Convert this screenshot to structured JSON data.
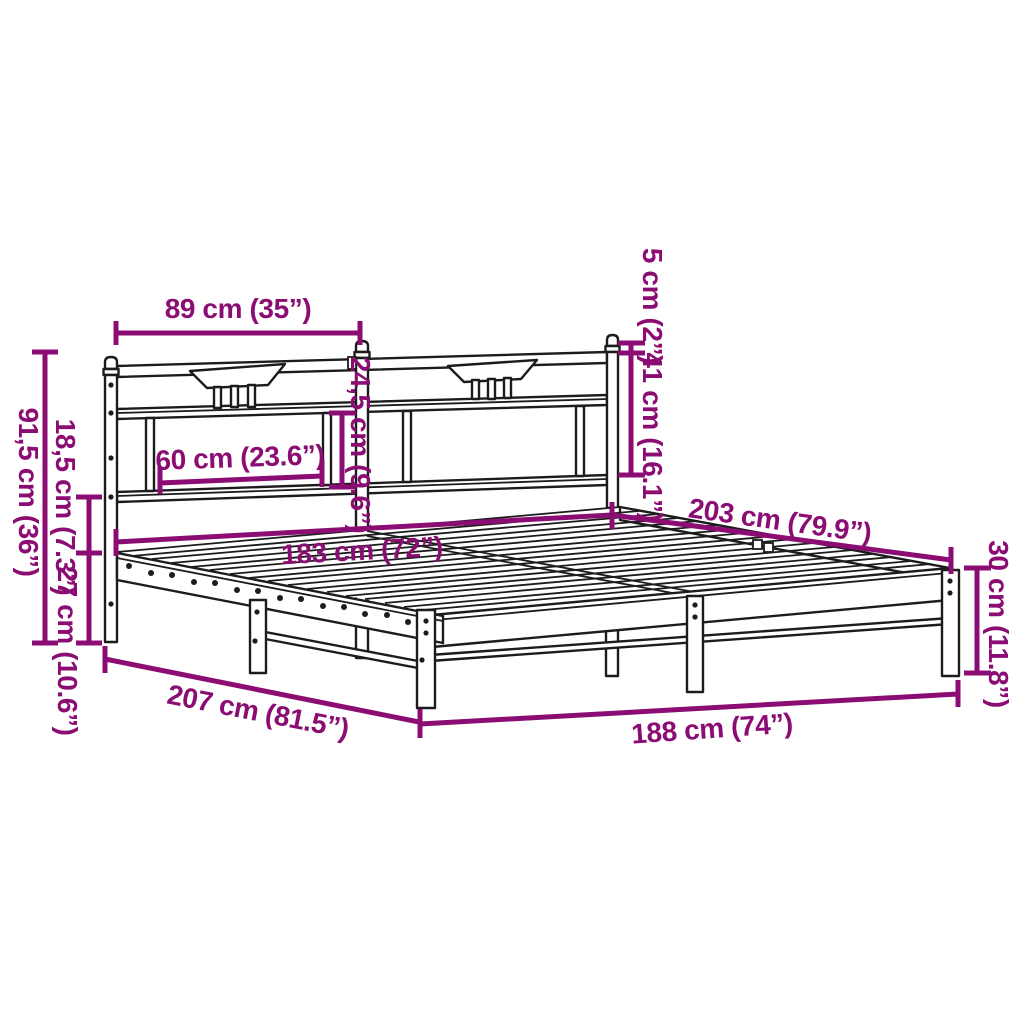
{
  "figure": {
    "type": "product-dimension-diagram",
    "subject": "metal bed frame with headboard, perspective line drawing",
    "accent_color": "#8B0D73",
    "line_color": "#1C1C1C",
    "background_color": "#FFFFFF"
  },
  "dimension_labels": {
    "headboard_section_width": "89 cm (35”)",
    "headboard_panel_inner_width": "60 cm (23.6”)",
    "headboard_panel_opening_height": "24,5 cm (9.6”)",
    "post_cap_height": "5 cm (2”)",
    "headboard_upper_height": "41 cm (16.1”)",
    "headboard_total_height": "91,5 cm (36”)",
    "rail_to_platform_height": "18,5 cm (7.3”)",
    "underbed_clearance": "27 cm (10.6”)",
    "mattress_width": "183 cm (72”)",
    "mattress_length": "203 cm (79.9”)",
    "platform_height": "30 cm (11.8”)",
    "frame_length": "207 cm (81.5”)",
    "frame_width": "188 cm (74”)"
  }
}
